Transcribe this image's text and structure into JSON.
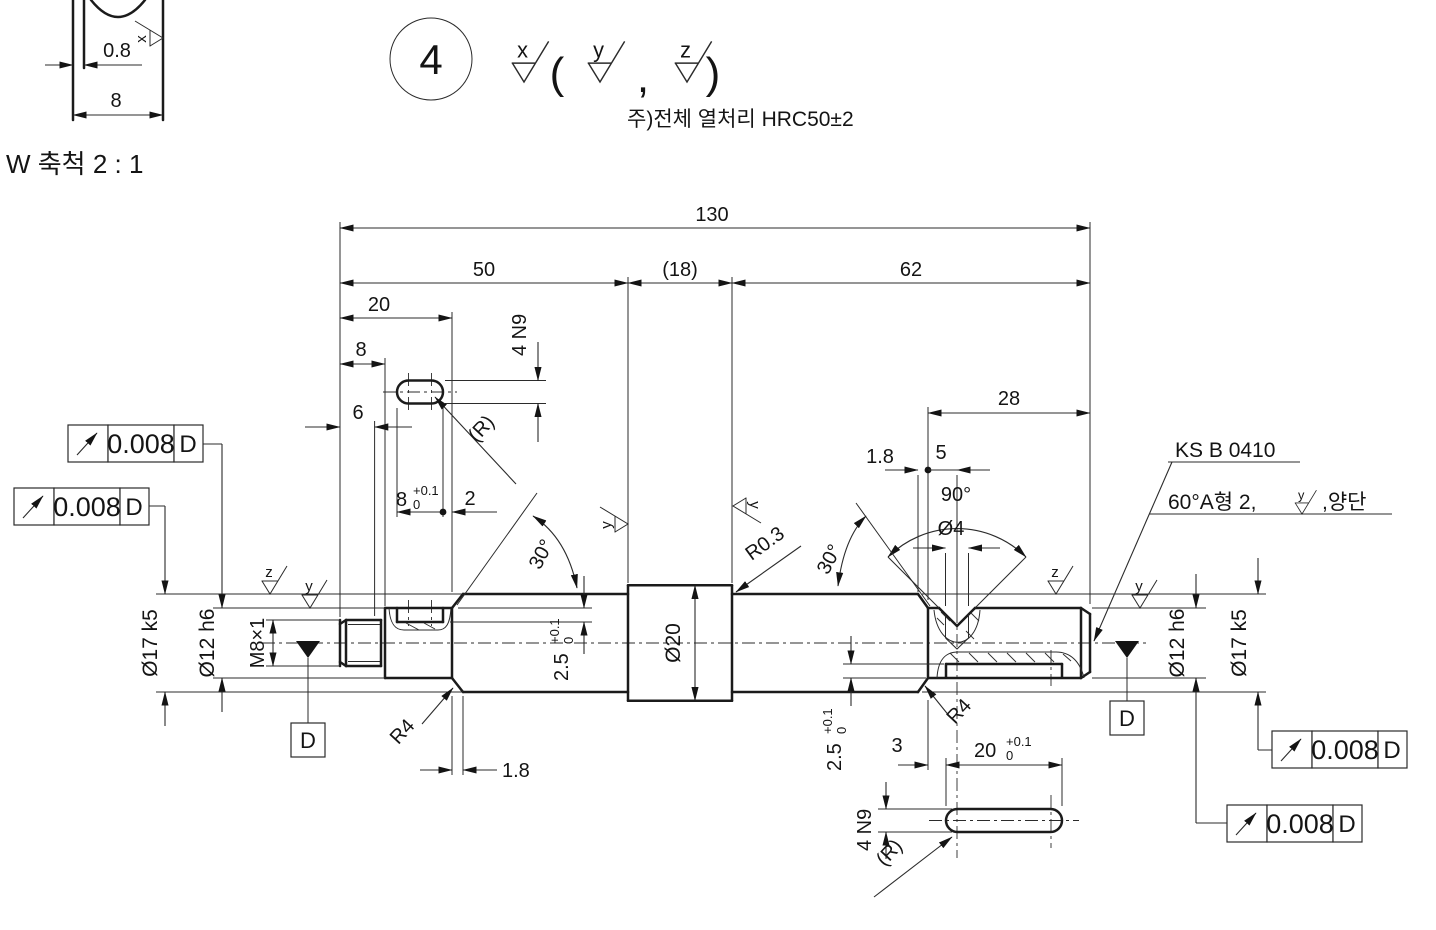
{
  "detail_w": {
    "title": "W 축척 2 : 1",
    "relief_width": "0.8",
    "thread_length": "8",
    "finish_mark": "x"
  },
  "balloon": {
    "number": "4"
  },
  "finish_note": {
    "primary_mark": "x",
    "paren_open": "(",
    "alt_mark_1": "y",
    "comma": ",",
    "alt_mark_2": "z",
    "paren_close": ")"
  },
  "notes": {
    "heat_treatment": "주)전체 열처리 HRC50±2",
    "center_standard": "KS B 0410",
    "center_spec_prefix": "60°A형 2,",
    "center_spec_mark": "y",
    "center_spec_suffix": ",양단"
  },
  "dims": {
    "total_length": "130",
    "left_section": "50",
    "collar_section": "(18)",
    "right_section": "62",
    "left_journal_length": "20",
    "thread_length": "8",
    "thread_full_length": "6",
    "right_journal_length": "28",
    "collar_dia": "Ø20",
    "collar_fillet": "R0.3",
    "chamfer_angle_left": "30°",
    "chamfer_angle_right": "30°",
    "chamfer_width_left": "1.8",
    "relief_width_right": "1.8",
    "shoulder_fillet_left": "R4",
    "shoulder_fillet_right": "R4",
    "center_hole_offset": "5",
    "center_hole_angle": "90°",
    "center_hole_dia": "Ø4",
    "keyway_left_length": "8",
    "keyway_left_end_gap": "2",
    "keyway_left_width": "4 N9",
    "keyway_left_radius": "(R)",
    "keyway_left_depth": "2.5",
    "keyway_right_offset": "3",
    "keyway_right_length": "20",
    "keyway_right_width": "4 N9",
    "keyway_right_radius": "(R)",
    "keyway_right_depth": "2.5",
    "tol_plus": "+0.1",
    "tol_zero": "0"
  },
  "labels": {
    "dia17_left": "Ø17 k5",
    "dia12_left": "Ø12 h6",
    "thread": "M8×1",
    "dia12_right": "Ø12 h6",
    "dia17_right": "Ø17 k5",
    "datum": "D"
  },
  "gdt": {
    "runout_value": "0.008",
    "datum_ref": "D"
  },
  "surface_marks": {
    "left_z": "z",
    "left_y": "y",
    "collar_left_y": "y",
    "collar_right_y": "y",
    "right_z": "z",
    "right_y": "y"
  }
}
